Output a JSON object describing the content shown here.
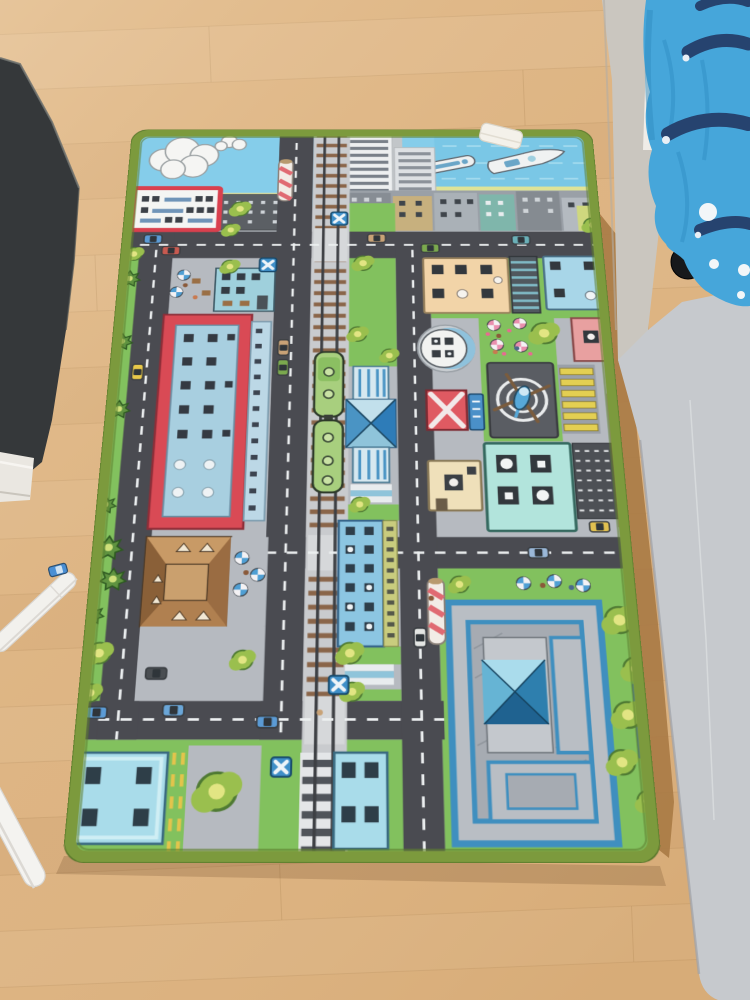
{
  "scene": {
    "type": "photograph",
    "description": "Top-down photo of a children's city-traffic play rug lying on a light oak wood floor, between a dark cabinet (top left), two white pens (bottom left), and a bed with a light frame, blue patterned duvet and a light gray side panel (right). A white care tag sticks out of the rug's top edge.",
    "room_objects": [
      "wood-floor",
      "dark-cabinet",
      "baseboard-molding",
      "stylus-pen",
      "second-pen",
      "toy-car-on-floor",
      "bed-frame",
      "blue-duvet",
      "caster-wheel",
      "gray-panel",
      "floor-shadow-wedge",
      "rug-care-tag"
    ],
    "rug_landmarks": [
      "green-border-trim",
      "sky-band",
      "clouds",
      "sea-with-boats",
      "skyline-towers",
      "city-building-row",
      "supermarket",
      "cafe-plaza",
      "cafe-building",
      "red-frame-building",
      "brown-roof-house",
      "blue-house-left",
      "blue-house-right",
      "railway-track",
      "green-train",
      "railway-station",
      "platform",
      "apartment-building",
      "roundabout-tower",
      "flower-garden",
      "helipad",
      "helicopter",
      "yellow-crosswalk",
      "red-kiosk",
      "sign-board",
      "cream-shop",
      "teal-building",
      "parking-lot",
      "orange-building",
      "school-complex",
      "school-pyramid-roof",
      "garden-parasols",
      "striped-pole-top",
      "striped-pole-bottom",
      "level-crossing",
      "crossing-signs",
      "trees",
      "bushes",
      "cars",
      "roads"
    ]
  },
  "colors": {
    "floor": "#ddb483",
    "floor_line": "#c19a6b",
    "furniture_dark": "#35383a",
    "molding": "#eae7e1",
    "pen": "#f2f1ed",
    "panel": "#c6c9cd",
    "frame": "#cac6bf",
    "duvet": "#46a6da",
    "duvet_navy": "#26436f",
    "duvet_dot": "#f2f6f8",
    "shadow_wedge": "#a87a45",
    "rug_trim": "#7c9a3d",
    "grass": "#82c15e",
    "road": "#4a4b51",
    "road_line": "#eceff0",
    "pavement": "#b6bac0",
    "track_ballast": "#c9cbce",
    "tie_brown": "#8a6549",
    "sky": "#85cdea",
    "horizon": "#dce28e",
    "cloud": "#f5f5f3",
    "supermarket_frame": "#d9404e",
    "red_building": "#d94a55",
    "red_building_inner": "#a8cfe0",
    "house_roof": "#b98a5c",
    "house_blue": "#a9dcea",
    "station_blue": "#7fc4e0",
    "school_blue": "#3f8fbf",
    "train_green": "#a8cf7e",
    "helipad": "#5a5d63",
    "crosswalk_yellow": "#e3cf52",
    "pink_building": "#e8a0a0",
    "peach_building": "#f2d4a8",
    "teal_building": "#b2e4dc",
    "orange_building": "#bf6a3c",
    "sign_blue": "#4a90c8",
    "taxi_yellow": "#e8c84a",
    "car_blue": "#5b9bd5"
  }
}
